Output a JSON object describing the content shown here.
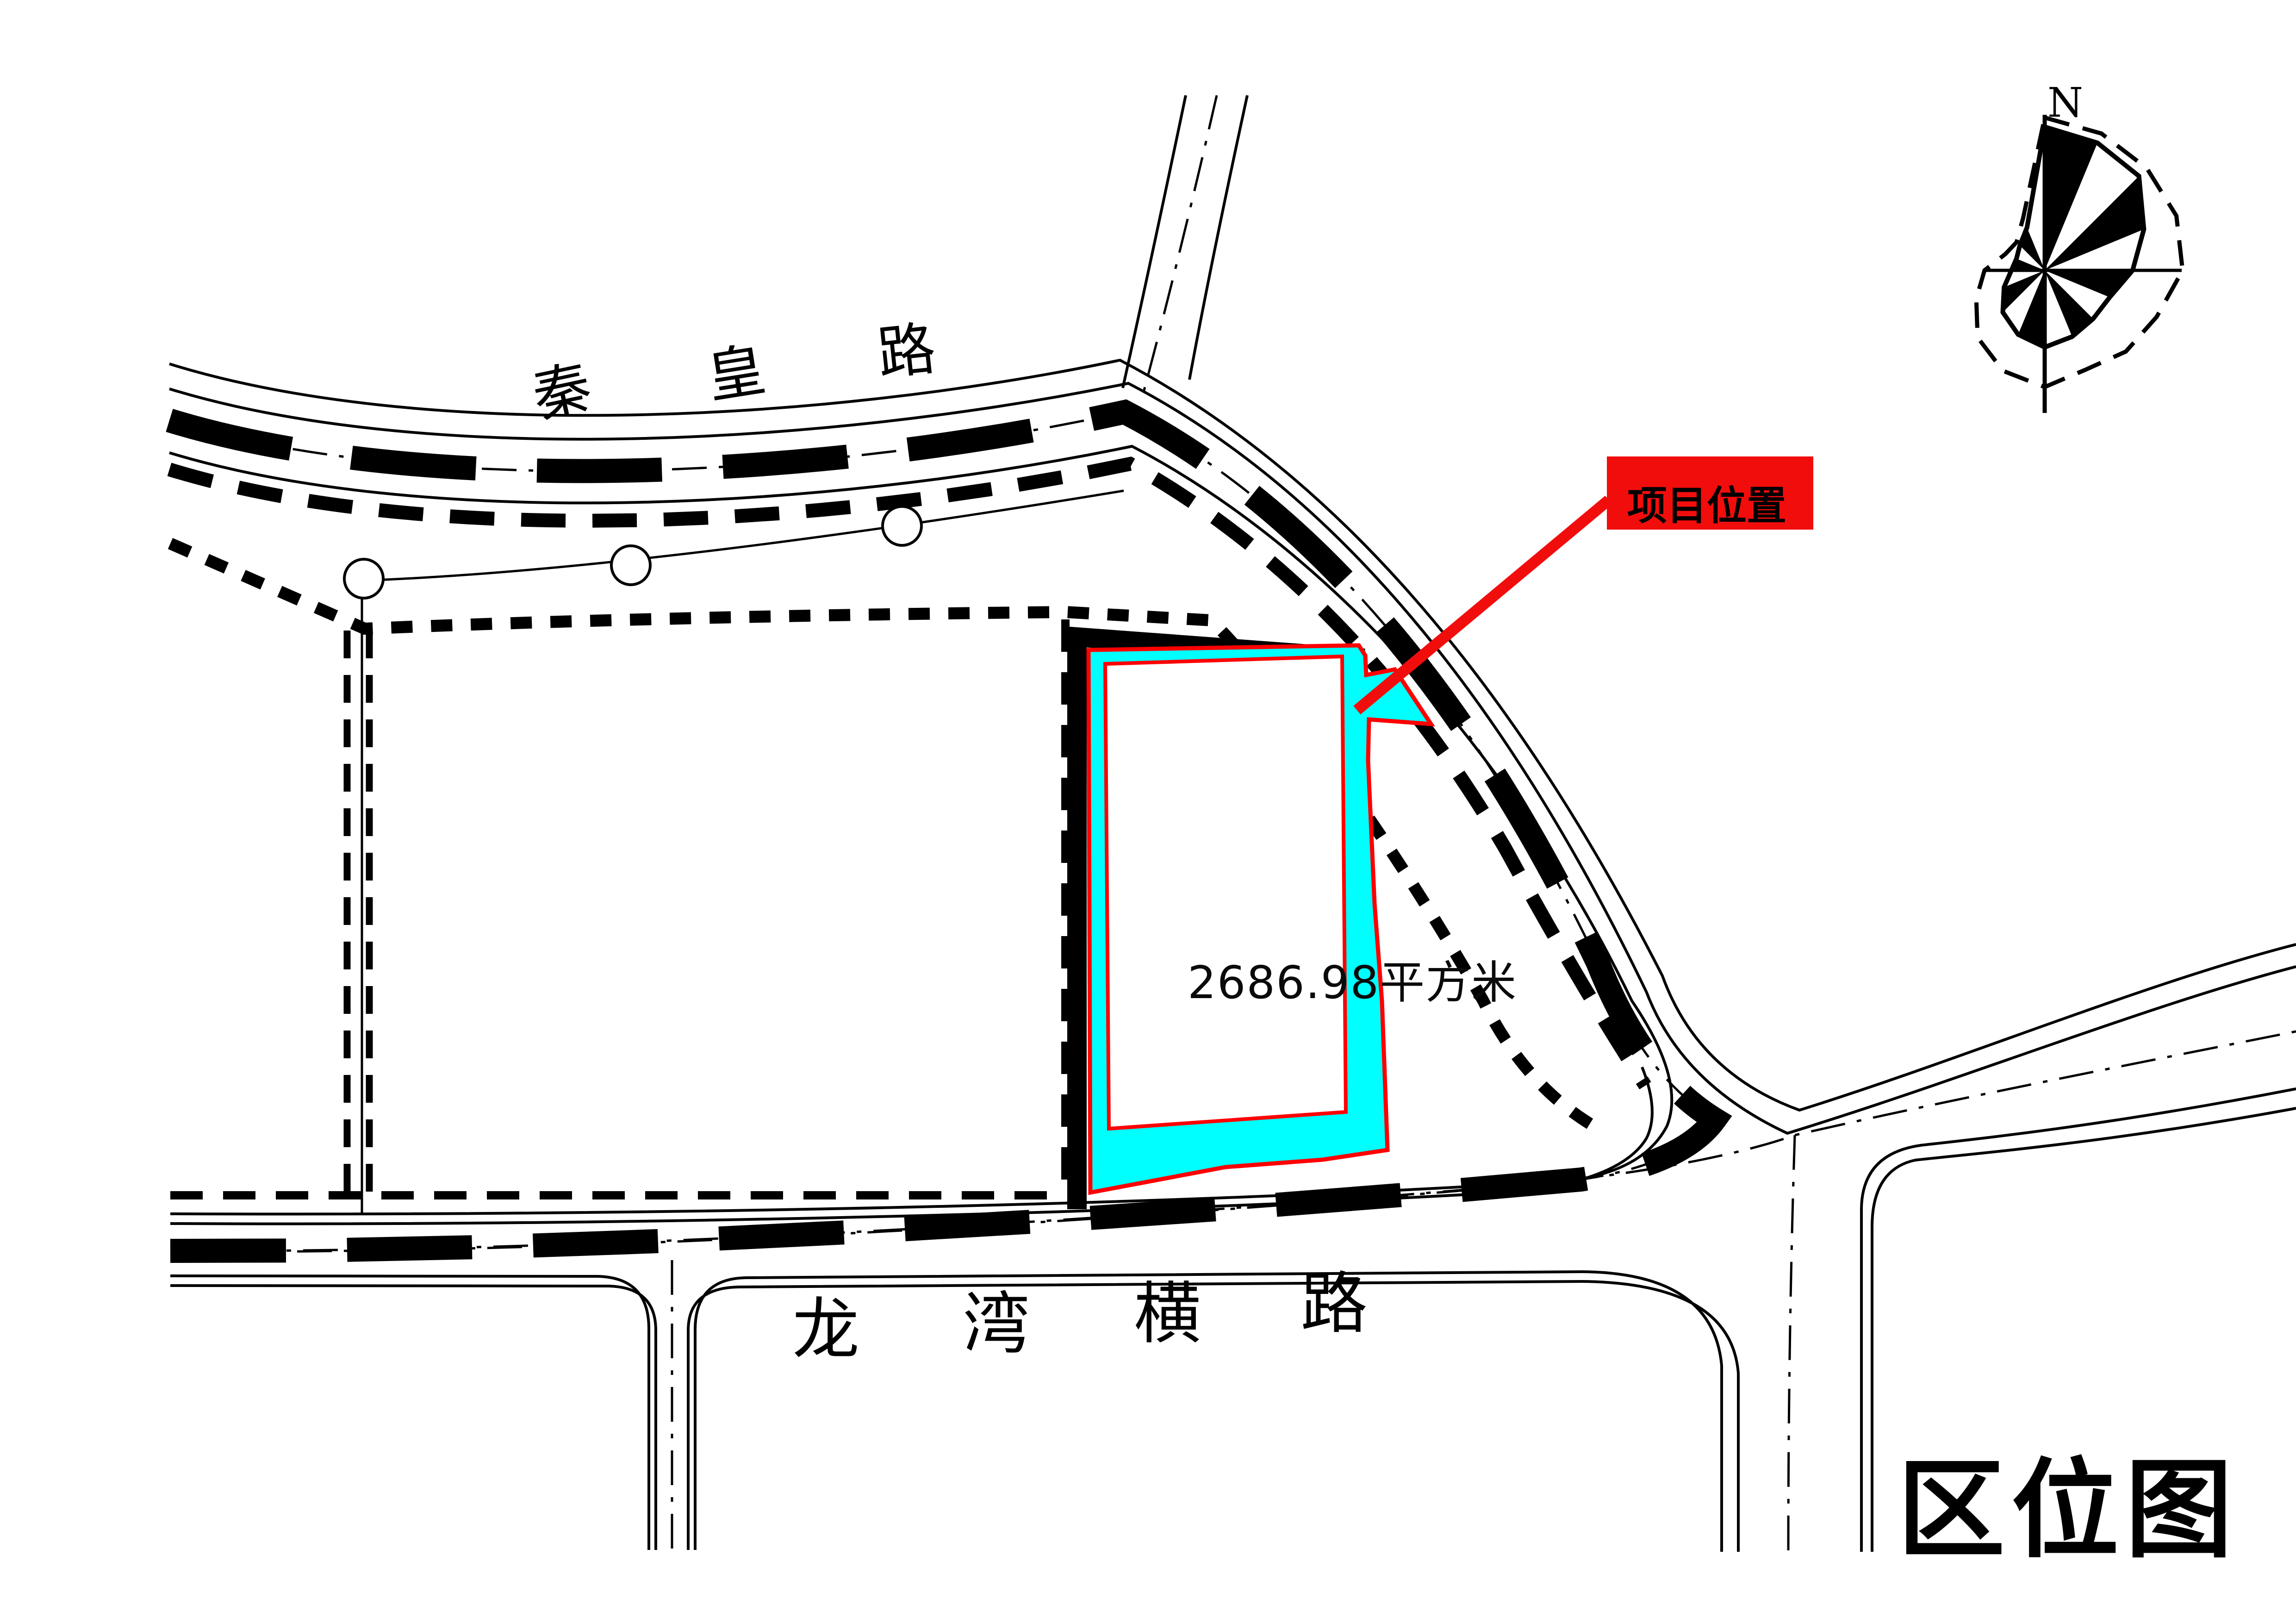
{
  "map": {
    "title": "区位图",
    "type_note": "location-map"
  },
  "compass": {
    "north_label": "N",
    "center": [
      4418,
      584
    ],
    "axis_v": [
      248,
      892
    ],
    "axis_h": [
      4284,
      4714
    ],
    "radii_solid": [
      310,
      298,
      288,
      232,
      190,
      152,
      148,
      155,
      166,
      150,
      128,
      95,
      72,
      66,
      76,
      100
    ],
    "radii_dashed": [
      330,
      320,
      312,
      308,
      298,
      262,
      248,
      232,
      252,
      235,
      205,
      160,
      130,
      92,
      86,
      122
    ],
    "black_sectors": [
      0,
      2,
      4,
      6,
      8,
      10,
      12,
      14
    ]
  },
  "roads": {
    "top_road_name": "秦皇路",
    "top_road_chars": [
      "秦",
      "皇",
      "路"
    ],
    "bottom_road_name": "龙湾横路",
    "bottom_road_chars": [
      "龙",
      "湾",
      "横",
      "路"
    ]
  },
  "parcel": {
    "area_label": "2686.98平方米",
    "fill_color": "#00FFFF",
    "boundary_color": "#FF0000"
  },
  "callout": {
    "label": "项目位置",
    "box_color": "#F20D0D",
    "leader_color": "#F20D0D",
    "text_color": "#000000"
  },
  "colors": {
    "background": "#FFFFFF",
    "linework": "#000000",
    "highlight_cyan": "#00FFFF",
    "highlight_red": "#FF0000"
  }
}
